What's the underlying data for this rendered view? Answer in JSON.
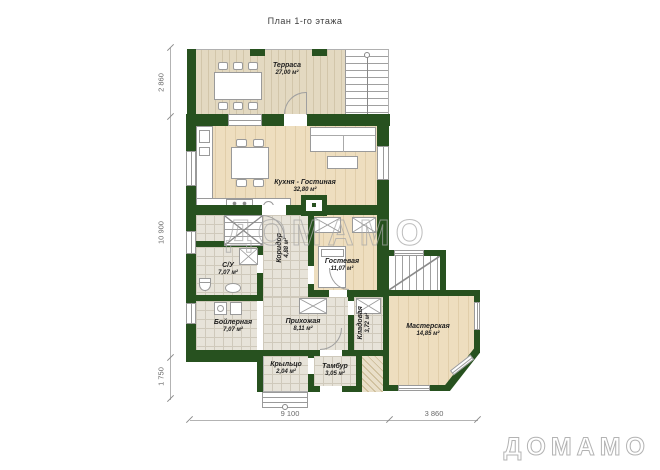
{
  "title": "План 1-го этажа",
  "watermark": "ДОМАМО",
  "brand_logo": "ДОМАМО",
  "rooms": {
    "terrace": {
      "name": "Терраса",
      "area": "27,00 м²"
    },
    "kitchen_living": {
      "name": "Кухня - Гостиная",
      "area": "32,80 м²"
    },
    "wc": {
      "name": "С/У",
      "area": "7,07 м²"
    },
    "boiler": {
      "name": "Бойлерная",
      "area": "7,07 м²"
    },
    "corridor": {
      "name": "Коридор",
      "area": "4,88 м²"
    },
    "guest": {
      "name": "Гостевая",
      "area": "11,07 м²"
    },
    "hallway": {
      "name": "Прихожая",
      "area": "8,11 м²"
    },
    "storage": {
      "name": "Кладовая",
      "area": "3,72 м²"
    },
    "workshop": {
      "name": "Мастерская",
      "area": "14,85 м²"
    },
    "porch": {
      "name": "Крыльцо",
      "area": "2,04 м²"
    },
    "vestibule": {
      "name": "Тамбур",
      "area": "3,05 м²"
    }
  },
  "dimensions": {
    "left_top": "2 860",
    "left_middle": "10 900",
    "left_bottom": "1 750",
    "bottom_left": "9 100",
    "bottom_right": "3 860"
  },
  "colors": {
    "wall_green": "#27511f",
    "wood_floor": "#eedebf",
    "deck_floor": "#e3d9c1",
    "tile_floor": "#e7e3d9",
    "watermark_outline": "#a8a8a8"
  }
}
